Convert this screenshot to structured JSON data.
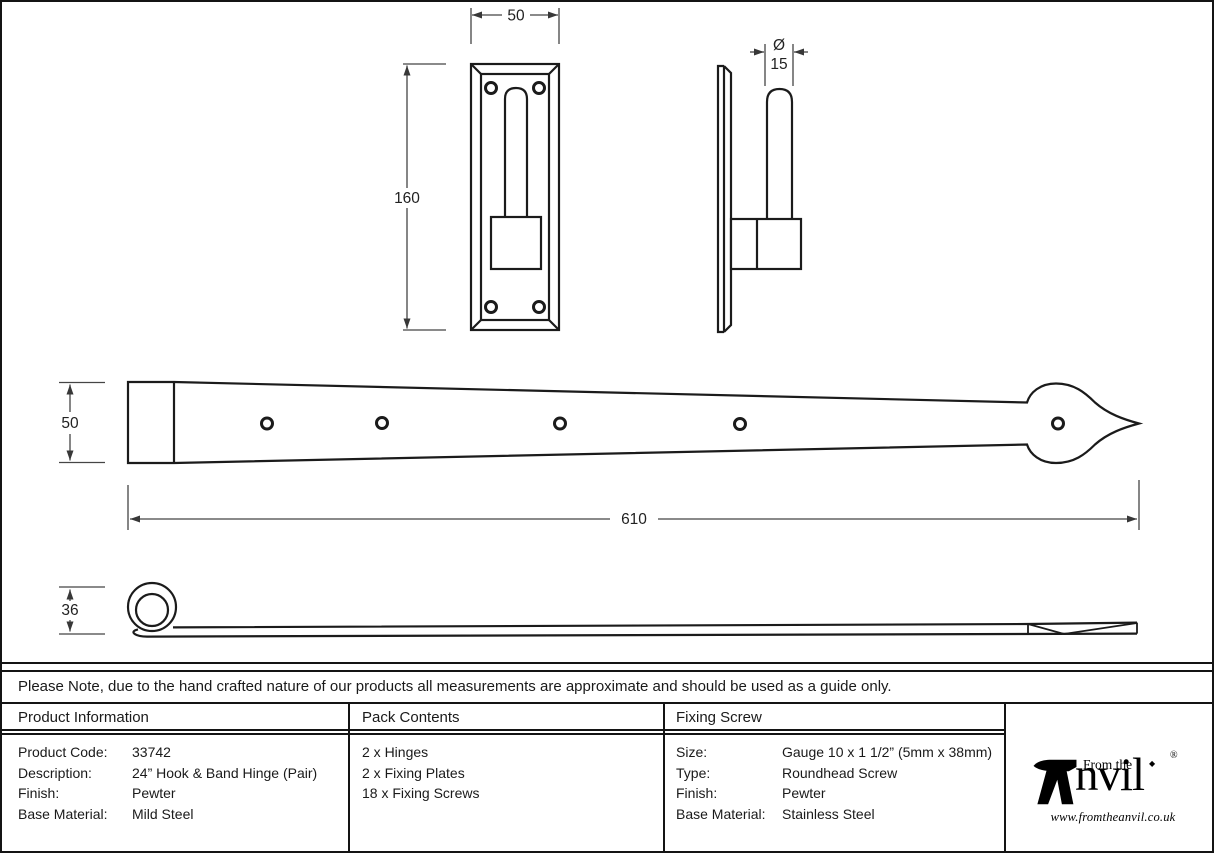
{
  "drawing": {
    "dims": {
      "plate_width": "50",
      "plate_height": "160",
      "pin_diameter_symbol": "Ø",
      "pin_diameter": "15",
      "band_width": "50",
      "band_length": "610",
      "side_height": "36"
    }
  },
  "note": "Please Note, due to the hand crafted nature of our products all measurements are approximate and should be used as a guide only.",
  "table": {
    "product": {
      "header": "Product Information",
      "rows": [
        {
          "label": "Product Code:",
          "value": "33742"
        },
        {
          "label": "Description:",
          "value": "24” Hook & Band Hinge (Pair)"
        },
        {
          "label": "Finish:",
          "value": "Pewter"
        },
        {
          "label": "Base Material:",
          "value": "Mild Steel"
        }
      ]
    },
    "pack": {
      "header": "Pack Contents",
      "items": [
        "2 x Hinges",
        "2 x Fixing Plates",
        "18 x Fixing Screws"
      ]
    },
    "screw": {
      "header": "Fixing Screw",
      "rows": [
        {
          "label": "Size:",
          "value": "Gauge 10 x 1 1/2” (5mm x 38mm)"
        },
        {
          "label": "Type:",
          "value": "Roundhead Screw"
        },
        {
          "label": "Finish:",
          "value": "Pewter"
        },
        {
          "label": "Base Material:",
          "value": "Stainless Steel"
        }
      ]
    }
  },
  "logo": {
    "from_the": "From the",
    "diamond": "◆",
    "name_rest": "nvil",
    "registered": "®",
    "url": "www.fromtheanvil.co.uk"
  }
}
